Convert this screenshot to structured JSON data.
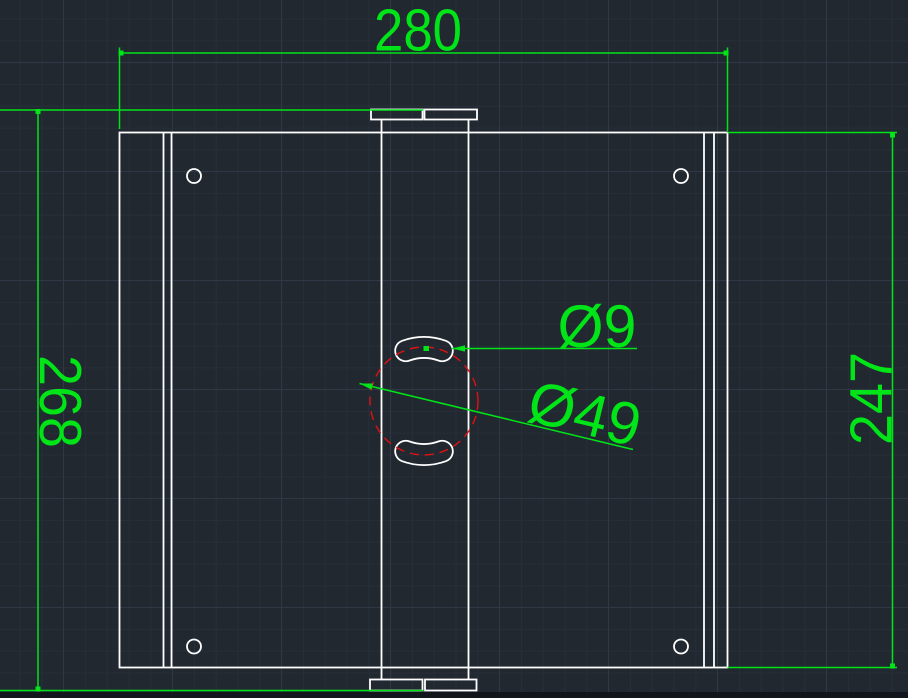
{
  "colors": {
    "background": "#212830",
    "grid_minor": "#272e3a",
    "grid_major": "#2f3845",
    "geometry": "#ffffff",
    "centerline": "#e01212",
    "annotation": "#00e418",
    "panel_edge": "#12161c"
  },
  "dimensions": {
    "overall_width": "280",
    "overall_height": "268",
    "plate_height": "247",
    "slot_diameter": "Ø9",
    "bolt_circle_diameter": "Ø49"
  }
}
